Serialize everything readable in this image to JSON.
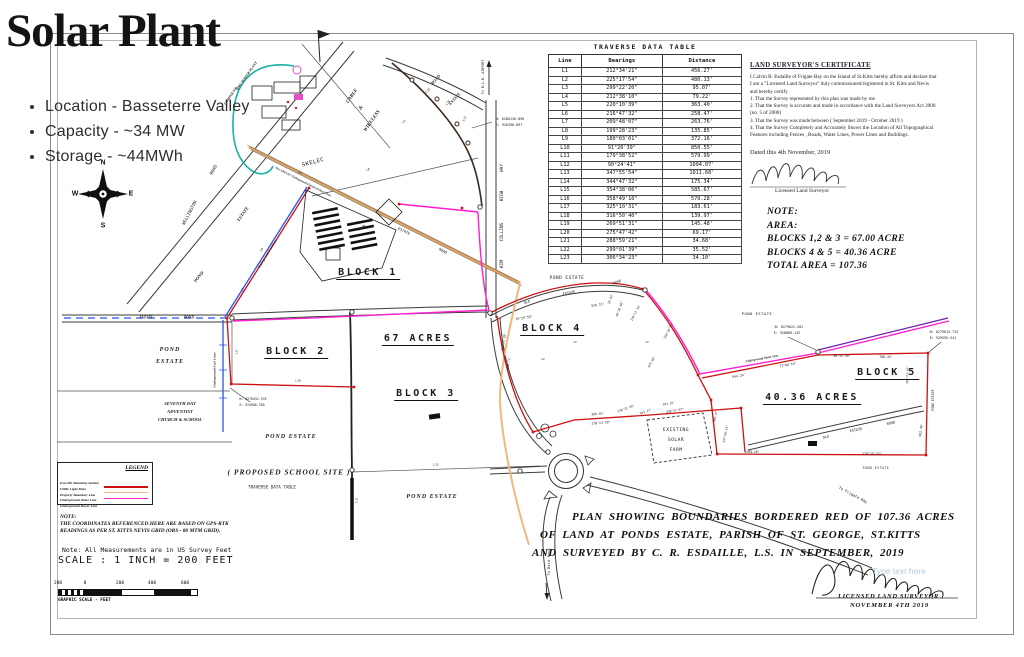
{
  "colors": {
    "boundary_red": "#cc1111",
    "magenta": "#ff1fd0",
    "orange": "#e2a25a",
    "light_orange": "#f0b87e",
    "blue": "#2753ee",
    "teal": "#17b3a6",
    "purple": "#6a1fae"
  },
  "slide": {
    "title": "Solar Plant",
    "bullets": [
      "Location - Basseterre Valley",
      "Capacity - ~34 MW",
      "Storage - ~44MWh"
    ]
  },
  "compass": {
    "n": "N",
    "e": "E",
    "s": "S",
    "w": "W"
  },
  "traverse_table": {
    "title": "TRAVERSE DATA TABLE",
    "columns": [
      "Line",
      "Bearings",
      "Distance"
    ],
    "rows": [
      [
        "L1",
        "212°34'21\"",
        "456.27'"
      ],
      [
        "L2",
        "225°17'54\"",
        "480.13'"
      ],
      [
        "L3",
        "299°22'20\"",
        "95.07'"
      ],
      [
        "L4",
        "212°38'10\"",
        "79.22'"
      ],
      [
        "L5",
        "220°10'39\"",
        "363.40'"
      ],
      [
        "L6",
        "216°47'32\"",
        "258.47'"
      ],
      [
        "L7",
        "209°48'07\"",
        "263.76'"
      ],
      [
        "L8",
        "199°28'23\"",
        "135.85'"
      ],
      [
        "L9",
        "180°03'01\"",
        "372.16'"
      ],
      [
        "L10",
        "91°20'39\"",
        "850.55'"
      ],
      [
        "L11",
        "179°38'52\"",
        "579.99'"
      ],
      [
        "L12",
        "90°24'41\"",
        "1094.07'"
      ],
      [
        "L13",
        "347°55'54\"",
        "1011.68'"
      ],
      [
        "L14",
        "344°47'32\"",
        "175.34'"
      ],
      [
        "L15",
        "354°38'06\"",
        "585.67'"
      ],
      [
        "L16",
        "358°49'10\"",
        "570.28'"
      ],
      [
        "L17",
        "325°10'31\"",
        "183.61'"
      ],
      [
        "L18",
        "316°50'40\"",
        "139.97'"
      ],
      [
        "L19",
        "269°51'31\"",
        "145.48'"
      ],
      [
        "L20",
        "275°47'42\"",
        "69.17'"
      ],
      [
        "L21",
        "288°59'21\"",
        "34.68'"
      ],
      [
        "L22",
        "299°01'39\"",
        "35.52'"
      ],
      [
        "L23",
        "306°34'23\"",
        "34.10'"
      ]
    ]
  },
  "certificate": {
    "heading": "LAND SURVEYOR'S CERTIFICATE",
    "lines": [
      "I Calvin R. Esdaille of Frigate Bay on the Island of St.Kitts hereby affirm and declare that",
      "I am a \"Licensed Land Surveyor\" duly commissioned/registered in St. Kitts and Nevis",
      "and hereby certify",
      "1. That the Survey represented by this plan was made by me",
      "2. That the Survey is accurate and made in accordance with the Land Surveyors Act 2000",
      "(no. 5 of 2000)",
      "3. That the Survey was made between ( September 2019 - October 2019 )",
      "4. That the Survey Completely and Accurately Shows the Location of All Topographical",
      "Features including Fences , Roads, Water Lines, Power Lines and Buildings."
    ],
    "dated": "Dated this 4th November, 2019",
    "signature_label": "Licensed Land Surveyor"
  },
  "area_note": {
    "lines": [
      "NOTE:",
      "AREA:",
      "BLOCKS 1,2 & 3 = 67.00 ACRE",
      "BLOCKS 4 & 5 = 40.36 ACRE",
      "TOTAL AREA = 107.36"
    ]
  },
  "plan_statement": {
    "lines": [
      "PLAN SHOWING BOUNDARIES BORDERED RED OF 107.36 ACRES",
      "OF LAND AT PONDS ESTATE, PARISH OF ST. GEORGE, ST.KITTS",
      "AND SURVEYED BY C. R. ESDAILLE, L.S. IN SEPTEMBER, 2019"
    ]
  },
  "notes": {
    "gps_lines": [
      "NOTE:",
      "THE COORDINATES REFERENCED HERE ARE BASED ON GPS-RTK",
      "READINGS AS PER ST. KITTS NEVIS GRID (ORS - 80 MTM GRID)."
    ],
    "measure": "Note: All Measurements are in US Survey Feet",
    "scale": "SCALE : 1 INCH = 200 FEET",
    "scalebar_ticks": [
      "200",
      "0",
      "200",
      "400",
      "600"
    ],
    "scalebar_caption": "GRAPHIC SCALE - FEET"
  },
  "legend": {
    "title": "LEGEND",
    "items": [
      {
        "label": "Iron Pin Boundary marker",
        "swatch": "",
        "kind": "symbol"
      },
      {
        "label": "Utility Light Poles",
        "swatch": "",
        "kind": "symbol"
      },
      {
        "label": "Property Boundary Line",
        "swatch": "#cc1111",
        "kind": "line"
      },
      {
        "label": "Underground Water Line",
        "swatch": "#f5b98d",
        "kind": "line"
      },
      {
        "label": "Underground Power Line",
        "swatch": "#ff1fd0",
        "kind": "line"
      }
    ]
  },
  "surveyor_block": {
    "line1": "LICENSED LAND SURVEYOR",
    "line2": "NOVEMBER 4TH 2019",
    "watermark": "Type text here"
  },
  "map_labels": [
    {
      "t": "BMC POWER PLANT",
      "x": 247,
      "y": 76,
      "r": -55,
      "fs": 3.6,
      "c": "est"
    },
    {
      "t": "COMPOUND",
      "x": 231,
      "y": 96,
      "r": -55,
      "fs": 3.6,
      "c": "est"
    },
    {
      "t": "CABLE",
      "x": 352,
      "y": 96,
      "r": -55,
      "fs": 5,
      "c": "est"
    },
    {
      "t": "&",
      "x": 361,
      "y": 108,
      "r": -55,
      "fs": 5,
      "c": "est"
    },
    {
      "t": "WIRELESS",
      "x": 372,
      "y": 121,
      "r": -55,
      "fs": 5,
      "c": "est"
    },
    {
      "t": "ROAD",
      "x": 436,
      "y": 80,
      "r": -48,
      "fs": 4.2,
      "c": "est"
    },
    {
      "t": "ESTATE",
      "x": 455,
      "y": 99,
      "r": -48,
      "fs": 4.2,
      "c": "est"
    },
    {
      "t": "To R.L.B. AIRPORT",
      "x": 483,
      "y": 77,
      "r": -90,
      "fs": 3.4,
      "c": "cad"
    },
    {
      "t": "N: 6280136.896",
      "x": 510,
      "y": 119,
      "r": 0,
      "fs": 3.4,
      "c": "cad"
    },
    {
      "t": "E: 926396.697",
      "x": 509,
      "y": 125,
      "r": 0,
      "fs": 3.4,
      "c": "cad"
    },
    {
      "t": "WAY",
      "x": 502,
      "y": 168,
      "r": -90,
      "fs": 4.4,
      "c": "cad"
    },
    {
      "t": "HIGH",
      "x": 502,
      "y": 196,
      "r": -90,
      "fs": 4.4,
      "c": "cad"
    },
    {
      "t": "COLLINS",
      "x": 502,
      "y": 232,
      "r": -90,
      "fs": 4.4,
      "c": "cad"
    },
    {
      "t": "KIM",
      "x": 502,
      "y": 264,
      "r": -90,
      "fs": 4.4,
      "c": "cad"
    },
    {
      "t": "WELLINGTON",
      "x": 190,
      "y": 213,
      "r": -62,
      "fs": 4.4,
      "c": "cad"
    },
    {
      "t": "ROAD",
      "x": 214,
      "y": 170,
      "r": -62,
      "fs": 4.4,
      "c": "cad"
    },
    {
      "t": "SKELEC",
      "x": 313,
      "y": 162,
      "r": -15,
      "fs": 5.5,
      "c": "cad sp"
    },
    {
      "t": "ESTATE",
      "x": 243,
      "y": 214,
      "r": -55,
      "fs": 4.6,
      "c": "est"
    },
    {
      "t": "POND",
      "x": 199,
      "y": 277,
      "r": -52,
      "fs": 4.6,
      "c": "est"
    },
    {
      "t": "New SKELEC Underground Electrical Duct Lines",
      "x": 303,
      "y": 182,
      "r": 27,
      "fs": 3,
      "c": "est"
    },
    {
      "t": "Underground Fuel Lines",
      "x": 268,
      "y": 254,
      "r": -58,
      "fs": 3.2,
      "c": "est"
    },
    {
      "t": "Drain",
      "x": 362,
      "y": 228,
      "r": -35,
      "fs": 3.4,
      "c": "est"
    },
    {
      "t": "ESTATE",
      "x": 404,
      "y": 231,
      "r": 27,
      "fs": 3.6,
      "c": "cad"
    },
    {
      "t": "ROAD",
      "x": 443,
      "y": 251,
      "r": 27,
      "fs": 3.6,
      "c": "cad"
    },
    {
      "t": "BLOCK 1",
      "x": 368,
      "y": 274,
      "r": 0,
      "fs": 10,
      "c": "blk"
    },
    {
      "t": "BLOCK 2",
      "x": 296,
      "y": 353,
      "r": 0,
      "fs": 10,
      "c": "blk"
    },
    {
      "t": "67 ACRES",
      "x": 418,
      "y": 340,
      "r": 0,
      "fs": 10,
      "c": "blk"
    },
    {
      "t": "BLOCK 3",
      "x": 426,
      "y": 395,
      "r": 0,
      "fs": 10,
      "c": "blk"
    },
    {
      "t": "BLOCK 4",
      "x": 552,
      "y": 330,
      "r": 0,
      "fs": 10,
      "c": "blk"
    },
    {
      "t": "BLOCK 5",
      "x": 887,
      "y": 374,
      "r": 0,
      "fs": 10,
      "c": "blk"
    },
    {
      "t": "40.36 ACRES",
      "x": 812,
      "y": 399,
      "r": 0,
      "fs": 10,
      "c": "blk"
    },
    {
      "t": "POND",
      "x": 170,
      "y": 350,
      "r": 0,
      "fs": 6,
      "c": "est sp"
    },
    {
      "t": "ESTATE",
      "x": 170,
      "y": 362,
      "r": 0,
      "fs": 6,
      "c": "est sp"
    },
    {
      "t": "ESTATE",
      "x": 146,
      "y": 318,
      "r": 0,
      "fs": 3.6,
      "c": "est"
    },
    {
      "t": "POND",
      "x": 189,
      "y": 318,
      "r": 0,
      "fs": 3.6,
      "c": "est"
    },
    {
      "t": "SEVENTH DAY",
      "x": 180,
      "y": 404,
      "r": 0,
      "fs": 4.6,
      "c": "est"
    },
    {
      "t": "ADVENTIST",
      "x": 180,
      "y": 412,
      "r": 0,
      "fs": 4.6,
      "c": "est"
    },
    {
      "t": "CHURCH & SCHOOL",
      "x": 180,
      "y": 420,
      "r": 0,
      "fs": 4.6,
      "c": "est"
    },
    {
      "t": "Underground Fuel Lines",
      "x": 215,
      "y": 370,
      "r": -90,
      "fs": 3.4,
      "c": "est"
    },
    {
      "t": "N: 6278432.576",
      "x": 253,
      "y": 399,
      "r": 0,
      "fs": 3.2,
      "c": "cad"
    },
    {
      "t": "E: 924966.780",
      "x": 252,
      "y": 405,
      "r": 0,
      "fs": 3.2,
      "c": "cad"
    },
    {
      "t": "L9",
      "x": 237,
      "y": 352,
      "r": -90,
      "fs": 3,
      "c": "cad"
    },
    {
      "t": "L18",
      "x": 298,
      "y": 381,
      "r": 0,
      "fs": 3,
      "c": "cad"
    },
    {
      "t": "L12",
      "x": 436,
      "y": 465,
      "r": 0,
      "fs": 3,
      "c": "cad"
    },
    {
      "t": "L11",
      "x": 357,
      "y": 500,
      "r": -90,
      "fs": 3,
      "c": "cad"
    },
    {
      "t": "L10",
      "x": 352,
      "y": 430,
      "r": -90,
      "fs": 3,
      "c": "cad"
    },
    {
      "t": "L6",
      "x": 262,
      "y": 250,
      "r": -58,
      "fs": 3,
      "c": "cad"
    },
    {
      "t": "L7",
      "x": 243,
      "y": 290,
      "r": -58,
      "fs": 3,
      "c": "cad"
    },
    {
      "t": "L5",
      "x": 300,
      "y": 173,
      "r": 27,
      "fs": 3,
      "c": "cad"
    },
    {
      "t": "L3",
      "x": 404,
      "y": 122,
      "r": -40,
      "fs": 3,
      "c": "cad"
    },
    {
      "t": "L8",
      "x": 368,
      "y": 170,
      "r": -13,
      "fs": 3,
      "c": "cad"
    },
    {
      "t": "L19",
      "x": 428,
      "y": 91,
      "r": -45,
      "fs": 3,
      "c": "cad"
    },
    {
      "t": "L18",
      "x": 448,
      "y": 103,
      "r": -52,
      "fs": 3,
      "c": "cad"
    },
    {
      "t": "L17",
      "x": 465,
      "y": 119,
      "r": -62,
      "fs": 3,
      "c": "cad"
    },
    {
      "t": "POND ESTATE",
      "x": 291,
      "y": 437,
      "r": 0,
      "fs": 6,
      "c": "est sp"
    },
    {
      "t": "( PROPOSED SCHOOL SITE )",
      "x": 289,
      "y": 472,
      "r": 0,
      "fs": 7.5,
      "c": "est sp"
    },
    {
      "t": "TRAVERSE DATA TABLE",
      "x": 272,
      "y": 487,
      "r": 0,
      "fs": 4.2,
      "c": "cad"
    },
    {
      "t": "POND ESTATE",
      "x": 432,
      "y": 497,
      "r": 0,
      "fs": 6,
      "c": "est sp"
    },
    {
      "t": "POND ESTATE",
      "x": 567,
      "y": 278,
      "r": 0,
      "fs": 4.4,
      "c": "cad sp"
    },
    {
      "t": "ROAD",
      "x": 617,
      "y": 282,
      "r": -18,
      "fs": 3.6,
      "c": "cad"
    },
    {
      "t": "ESTATE",
      "x": 569,
      "y": 293,
      "r": -10,
      "fs": 3.6,
      "c": "cad"
    },
    {
      "t": "OLD",
      "x": 527,
      "y": 302,
      "r": -15,
      "fs": 3.6,
      "c": "cad"
    },
    {
      "t": "70°29'50\"",
      "x": 524,
      "y": 318,
      "r": -10,
      "fs": 3.2,
      "c": "cad"
    },
    {
      "t": "936.15'",
      "x": 598,
      "y": 305,
      "r": -10,
      "fs": 3.2,
      "c": "cad"
    },
    {
      "t": "20.83'",
      "x": 611,
      "y": 299,
      "r": -70,
      "fs": 3,
      "c": "cad"
    },
    {
      "t": "99°20'40\"",
      "x": 620,
      "y": 309,
      "r": -70,
      "fs": 3,
      "c": "cad"
    },
    {
      "t": "120°17'19\"",
      "x": 636,
      "y": 313,
      "r": -62,
      "fs": 3,
      "c": "cad"
    },
    {
      "t": "150°28'55\"",
      "x": 669,
      "y": 331,
      "r": -62,
      "fs": 3,
      "c": "cad"
    },
    {
      "t": "479.68'",
      "x": 652,
      "y": 362,
      "r": -62,
      "fs": 3,
      "c": "cad"
    },
    {
      "t": "347°35'28\"",
      "x": 504,
      "y": 342,
      "r": -80,
      "fs": 3,
      "c": "cad"
    },
    {
      "t": "464.72'",
      "x": 509,
      "y": 363,
      "r": -80,
      "fs": 3,
      "c": "cad"
    },
    {
      "t": "LP",
      "x": 575,
      "y": 343,
      "r": 0,
      "fs": 2.8,
      "c": "cad"
    },
    {
      "t": "LP",
      "x": 543,
      "y": 360,
      "r": 0,
      "fs": 2.8,
      "c": "cad"
    },
    {
      "t": "LP",
      "x": 647,
      "y": 343,
      "r": 0,
      "fs": 2.8,
      "c": "cad"
    },
    {
      "t": "366.81'",
      "x": 598,
      "y": 414,
      "r": -5,
      "fs": 3.2,
      "c": "cad"
    },
    {
      "t": "270°21'38\"",
      "x": 601,
      "y": 423,
      "r": -5,
      "fs": 3.2,
      "c": "cad"
    },
    {
      "t": "238°13'39\"",
      "x": 626,
      "y": 409,
      "r": -20,
      "fs": 3,
      "c": "cad"
    },
    {
      "t": "551.17'",
      "x": 646,
      "y": 412,
      "r": -20,
      "fs": 3,
      "c": "cad"
    },
    {
      "t": "951.91'",
      "x": 669,
      "y": 404,
      "r": -10,
      "fs": 3,
      "c": "cad"
    },
    {
      "t": "238°37'43\"",
      "x": 675,
      "y": 411,
      "r": -10,
      "fs": 3,
      "c": "cad"
    },
    {
      "t": "EXISTING",
      "x": 676,
      "y": 430,
      "r": 0,
      "fs": 4.6,
      "c": "cad sp"
    },
    {
      "t": "SOLAR",
      "x": 676,
      "y": 440,
      "r": 0,
      "fs": 4.6,
      "c": "cad sp"
    },
    {
      "t": "FARM",
      "x": 676,
      "y": 450,
      "r": 0,
      "fs": 4.6,
      "c": "cad sp"
    },
    {
      "t": "POND ESTATE",
      "x": 757,
      "y": 314,
      "r": 0,
      "fs": 3.8,
      "c": "cad sp"
    },
    {
      "t": "N: 6279622.262",
      "x": 789,
      "y": 327,
      "r": 0,
      "fs": 3.4,
      "c": "cad"
    },
    {
      "t": "E: 928889.132",
      "x": 787,
      "y": 333,
      "r": 0,
      "fs": 3.4,
      "c": "cad"
    },
    {
      "t": "N: 6279615.725",
      "x": 944,
      "y": 332,
      "r": 0,
      "fs": 3.4,
      "c": "cad"
    },
    {
      "t": "E: 929595.541",
      "x": 943,
      "y": 338,
      "r": 0,
      "fs": 3.4,
      "c": "cad"
    },
    {
      "t": "Underground Water Line",
      "x": 762,
      "y": 359,
      "r": -10,
      "fs": 3.2,
      "c": "est"
    },
    {
      "t": "77°06'10\"",
      "x": 788,
      "y": 365,
      "r": -10,
      "fs": 3.2,
      "c": "cad"
    },
    {
      "t": "844.24'",
      "x": 739,
      "y": 376,
      "r": -10,
      "fs": 3.2,
      "c": "cad"
    },
    {
      "t": "90°31'49\"",
      "x": 842,
      "y": 356,
      "r": 0,
      "fs": 3.2,
      "c": "cad"
    },
    {
      "t": "706.44'",
      "x": 886,
      "y": 357,
      "r": 0,
      "fs": 3.2,
      "c": "cad"
    },
    {
      "t": "189°23'36\"",
      "x": 908,
      "y": 375,
      "r": -88,
      "fs": 3,
      "c": "cad"
    },
    {
      "t": "POND ESTATE",
      "x": 933,
      "y": 400,
      "r": -90,
      "fs": 3.2,
      "c": "cad"
    },
    {
      "t": "402.47'",
      "x": 716,
      "y": 416,
      "r": -78,
      "fs": 3,
      "c": "cad"
    },
    {
      "t": "347°49'23\"",
      "x": 726,
      "y": 434,
      "r": -78,
      "fs": 3,
      "c": "cad"
    },
    {
      "t": "OLD",
      "x": 826,
      "y": 437,
      "r": -10,
      "fs": 3.6,
      "c": "cad"
    },
    {
      "t": "ESTATE",
      "x": 856,
      "y": 430,
      "r": -10,
      "fs": 3.6,
      "c": "cad"
    },
    {
      "t": "ROAD",
      "x": 891,
      "y": 423,
      "r": -12,
      "fs": 3.6,
      "c": "cad"
    },
    {
      "t": "1288.18'",
      "x": 752,
      "y": 452,
      "r": 0,
      "fs": 3.2,
      "c": "cad"
    },
    {
      "t": "270°15'22\"",
      "x": 872,
      "y": 454,
      "r": 0,
      "fs": 3.2,
      "c": "cad"
    },
    {
      "t": "682.46'",
      "x": 921,
      "y": 430,
      "r": -82,
      "fs": 3.2,
      "c": "cad"
    },
    {
      "t": "POND ESTATE",
      "x": 876,
      "y": 468,
      "r": 0,
      "fs": 3.2,
      "c": "cad sp"
    },
    {
      "t": "To Frigate Bay",
      "x": 853,
      "y": 495,
      "r": 28,
      "fs": 3.8,
      "c": "cad"
    },
    {
      "t": "To Bird Rock",
      "x": 549,
      "y": 562,
      "r": -90,
      "fs": 3.8,
      "c": "cad"
    }
  ]
}
